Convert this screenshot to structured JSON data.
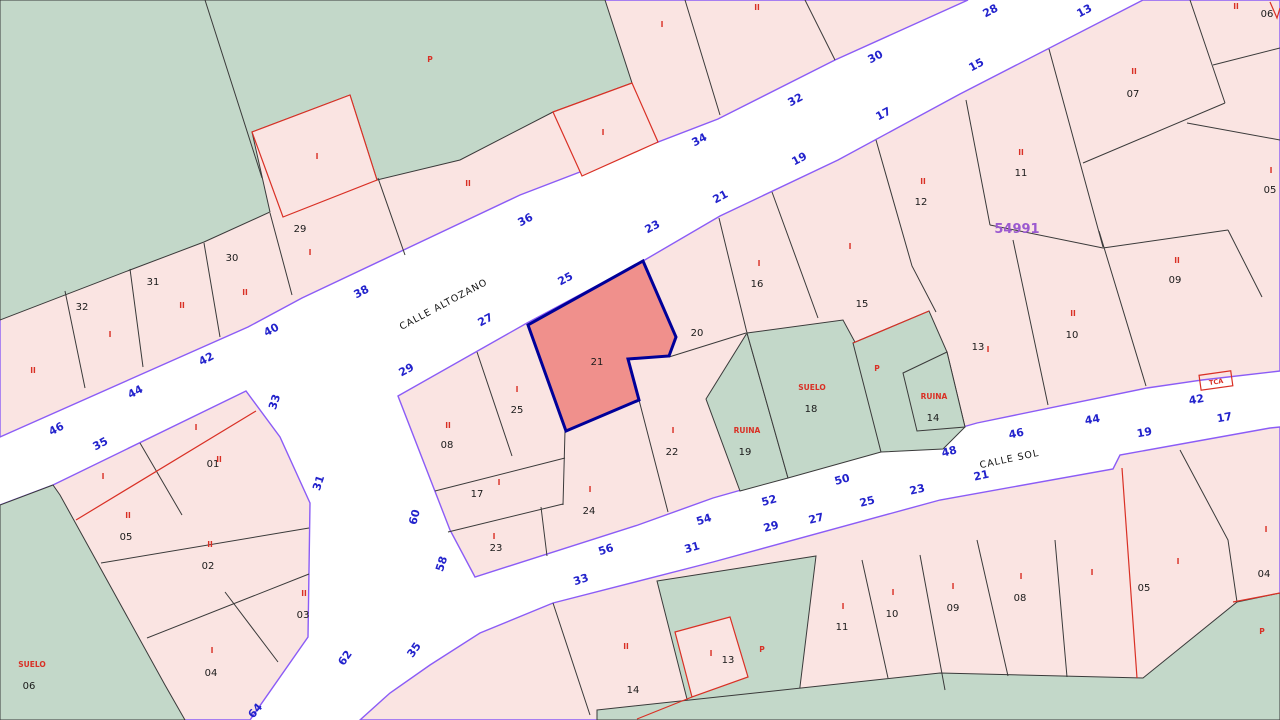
{
  "map_type": "cadastral-parcel-map",
  "block_number": {
    "t": "54991"
  },
  "tca": {
    "text": "TCA"
  },
  "highlighted_parcel": {
    "label": "21",
    "fill": "#f0908c",
    "stroke": "#000099"
  },
  "colors": {
    "street_white": "#ffffff",
    "parcel_pink": "#fae4e2",
    "green_area": "#c3d8c9",
    "block_outline_purple": "#8b5cf6",
    "parcel_line_black": "#3a3a3a",
    "annotation_red": "#d93025",
    "house_number_blue": "#2222cc",
    "block_number_purple": "#9b59d0"
  },
  "streets": [
    {
      "t": "CALLE ALTOZANO",
      "x": 445,
      "y": 307,
      "r": -28
    },
    {
      "t": "CALLE SOL",
      "x": 1010,
      "y": 462,
      "r": -12
    }
  ],
  "house_numbers": [
    {
      "t": "46",
      "x": 58,
      "y": 432,
      "r": -28
    },
    {
      "t": "44",
      "x": 137,
      "y": 395,
      "r": -28
    },
    {
      "t": "42",
      "x": 208,
      "y": 362,
      "r": -28
    },
    {
      "t": "40",
      "x": 273,
      "y": 333,
      "r": -28
    },
    {
      "t": "38",
      "x": 363,
      "y": 295,
      "r": -28
    },
    {
      "t": "36",
      "x": 527,
      "y": 223,
      "r": -28
    },
    {
      "t": "34",
      "x": 701,
      "y": 143,
      "r": -28
    },
    {
      "t": "32",
      "x": 797,
      "y": 103,
      "r": -28
    },
    {
      "t": "30",
      "x": 877,
      "y": 60,
      "r": -28
    },
    {
      "t": "28",
      "x": 992,
      "y": 14,
      "r": -28
    },
    {
      "t": "35",
      "x": 102,
      "y": 447,
      "r": -28
    },
    {
      "t": "29",
      "x": 408,
      "y": 373,
      "r": -28
    },
    {
      "t": "27",
      "x": 487,
      "y": 323,
      "r": -28
    },
    {
      "t": "25",
      "x": 567,
      "y": 282,
      "r": -28
    },
    {
      "t": "23",
      "x": 654,
      "y": 230,
      "r": -28
    },
    {
      "t": "21",
      "x": 722,
      "y": 200,
      "r": -28
    },
    {
      "t": "19",
      "x": 801,
      "y": 162,
      "r": -28
    },
    {
      "t": "17",
      "x": 885,
      "y": 117,
      "r": -28
    },
    {
      "t": "15",
      "x": 978,
      "y": 68,
      "r": -28
    },
    {
      "t": "13",
      "x": 1086,
      "y": 14,
      "r": -28
    },
    {
      "t": "33",
      "x": 278,
      "y": 403,
      "r": -72
    },
    {
      "t": "31",
      "x": 322,
      "y": 484,
      "r": -72
    },
    {
      "t": "60",
      "x": 418,
      "y": 518,
      "r": -75
    },
    {
      "t": "58",
      "x": 445,
      "y": 565,
      "r": -72
    },
    {
      "t": "62",
      "x": 348,
      "y": 660,
      "r": -55
    },
    {
      "t": "64",
      "x": 258,
      "y": 713,
      "r": -50
    },
    {
      "t": "35",
      "x": 417,
      "y": 652,
      "r": -55
    },
    {
      "t": "56",
      "x": 607,
      "y": 553,
      "r": -18
    },
    {
      "t": "54",
      "x": 705,
      "y": 523,
      "r": -18
    },
    {
      "t": "52",
      "x": 770,
      "y": 504,
      "r": -15
    },
    {
      "t": "50",
      "x": 843,
      "y": 483,
      "r": -15
    },
    {
      "t": "48",
      "x": 950,
      "y": 455,
      "r": -14
    },
    {
      "t": "46",
      "x": 1017,
      "y": 437,
      "r": -12
    },
    {
      "t": "44",
      "x": 1093,
      "y": 423,
      "r": -10
    },
    {
      "t": "42",
      "x": 1197,
      "y": 403,
      "r": -10
    },
    {
      "t": "33",
      "x": 582,
      "y": 583,
      "r": -18
    },
    {
      "t": "31",
      "x": 693,
      "y": 551,
      "r": -16
    },
    {
      "t": "29",
      "x": 772,
      "y": 530,
      "r": -15
    },
    {
      "t": "27",
      "x": 817,
      "y": 522,
      "r": -14
    },
    {
      "t": "25",
      "x": 868,
      "y": 505,
      "r": -14
    },
    {
      "t": "23",
      "x": 918,
      "y": 493,
      "r": -13
    },
    {
      "t": "21",
      "x": 982,
      "y": 479,
      "r": -12
    },
    {
      "t": "19",
      "x": 1145,
      "y": 436,
      "r": -10
    },
    {
      "t": "17",
      "x": 1225,
      "y": 421,
      "r": -10
    }
  ],
  "parcel_numbers": [
    {
      "t": "32",
      "x": 82,
      "y": 310
    },
    {
      "t": "31",
      "x": 153,
      "y": 285
    },
    {
      "t": "30",
      "x": 232,
      "y": 261
    },
    {
      "t": "29",
      "x": 300,
      "y": 232
    },
    {
      "t": "01",
      "x": 213,
      "y": 467
    },
    {
      "t": "05",
      "x": 126,
      "y": 540
    },
    {
      "t": "02",
      "x": 208,
      "y": 569
    },
    {
      "t": "03",
      "x": 303,
      "y": 618
    },
    {
      "t": "04",
      "x": 211,
      "y": 676
    },
    {
      "t": "06",
      "x": 29,
      "y": 689
    },
    {
      "t": "08",
      "x": 447,
      "y": 448
    },
    {
      "t": "25",
      "x": 517,
      "y": 413
    },
    {
      "t": "17",
      "x": 477,
      "y": 497
    },
    {
      "t": "23",
      "x": 496,
      "y": 551
    },
    {
      "t": "24",
      "x": 589,
      "y": 514
    },
    {
      "t": "21",
      "x": 597,
      "y": 365
    },
    {
      "t": "22",
      "x": 672,
      "y": 455
    },
    {
      "t": "20",
      "x": 697,
      "y": 336
    },
    {
      "t": "16",
      "x": 757,
      "y": 287
    },
    {
      "t": "15",
      "x": 862,
      "y": 307
    },
    {
      "t": "12",
      "x": 921,
      "y": 205
    },
    {
      "t": "11",
      "x": 1021,
      "y": 176
    },
    {
      "t": "07",
      "x": 1133,
      "y": 97
    },
    {
      "t": "06",
      "x": 1267,
      "y": 17
    },
    {
      "t": "05",
      "x": 1270,
      "y": 193
    },
    {
      "t": "13",
      "x": 978,
      "y": 350
    },
    {
      "t": "09",
      "x": 1175,
      "y": 283
    },
    {
      "t": "10",
      "x": 1072,
      "y": 338
    },
    {
      "t": "18",
      "x": 811,
      "y": 412
    },
    {
      "t": "19",
      "x": 745,
      "y": 455
    },
    {
      "t": "14",
      "x": 933,
      "y": 421
    },
    {
      "t": "14",
      "x": 633,
      "y": 693
    },
    {
      "t": "13",
      "x": 728,
      "y": 663
    },
    {
      "t": "11",
      "x": 842,
      "y": 630
    },
    {
      "t": "10",
      "x": 892,
      "y": 617
    },
    {
      "t": "09",
      "x": 953,
      "y": 611
    },
    {
      "t": "08",
      "x": 1020,
      "y": 601
    },
    {
      "t": "05",
      "x": 1144,
      "y": 591
    },
    {
      "t": "04",
      "x": 1264,
      "y": 577
    }
  ],
  "red_marks": [
    {
      "t": "I",
      "x": 317,
      "y": 159
    },
    {
      "t": "I",
      "x": 603,
      "y": 135
    },
    {
      "t": "II",
      "x": 468,
      "y": 186
    },
    {
      "t": "P",
      "x": 430,
      "y": 62
    },
    {
      "t": "I",
      "x": 662,
      "y": 27
    },
    {
      "t": "II",
      "x": 757,
      "y": 10
    },
    {
      "t": "I",
      "x": 110,
      "y": 337
    },
    {
      "t": "II",
      "x": 182,
      "y": 308
    },
    {
      "t": "II",
      "x": 33,
      "y": 373
    },
    {
      "t": "II",
      "x": 245,
      "y": 295
    },
    {
      "t": "I",
      "x": 310,
      "y": 255
    },
    {
      "t": "I",
      "x": 196,
      "y": 430
    },
    {
      "t": "II",
      "x": 219,
      "y": 462
    },
    {
      "t": "I",
      "x": 103,
      "y": 479
    },
    {
      "t": "II",
      "x": 128,
      "y": 518
    },
    {
      "t": "II",
      "x": 210,
      "y": 547
    },
    {
      "t": "II",
      "x": 304,
      "y": 596
    },
    {
      "t": "I",
      "x": 212,
      "y": 653
    },
    {
      "t": "SUELO",
      "x": 32,
      "y": 667
    },
    {
      "t": "II",
      "x": 448,
      "y": 428
    },
    {
      "t": "I",
      "x": 517,
      "y": 392
    },
    {
      "t": "I",
      "x": 499,
      "y": 485
    },
    {
      "t": "I",
      "x": 494,
      "y": 539
    },
    {
      "t": "I",
      "x": 590,
      "y": 492
    },
    {
      "t": "I",
      "x": 673,
      "y": 433
    },
    {
      "t": "I",
      "x": 759,
      "y": 266
    },
    {
      "t": "I",
      "x": 850,
      "y": 249
    },
    {
      "t": "II",
      "x": 923,
      "y": 184
    },
    {
      "t": "II",
      "x": 1021,
      "y": 155
    },
    {
      "t": "II",
      "x": 1134,
      "y": 74
    },
    {
      "t": "II",
      "x": 1236,
      "y": 9
    },
    {
      "t": "I",
      "x": 1271,
      "y": 173
    },
    {
      "t": "I",
      "x": 988,
      "y": 352
    },
    {
      "t": "II",
      "x": 1177,
      "y": 263
    },
    {
      "t": "II",
      "x": 1073,
      "y": 316
    },
    {
      "t": "SUELO",
      "x": 812,
      "y": 390
    },
    {
      "t": "RUINA",
      "x": 747,
      "y": 433
    },
    {
      "t": "RUINA",
      "x": 934,
      "y": 399
    },
    {
      "t": "P",
      "x": 877,
      "y": 371
    },
    {
      "t": "II",
      "x": 626,
      "y": 649
    },
    {
      "t": "I",
      "x": 711,
      "y": 656
    },
    {
      "t": "P",
      "x": 762,
      "y": 652
    },
    {
      "t": "I",
      "x": 843,
      "y": 609
    },
    {
      "t": "I",
      "x": 893,
      "y": 595
    },
    {
      "t": "I",
      "x": 953,
      "y": 589
    },
    {
      "t": "I",
      "x": 1021,
      "y": 579
    },
    {
      "t": "I",
      "x": 1092,
      "y": 575
    },
    {
      "t": "I",
      "x": 1178,
      "y": 564
    },
    {
      "t": "I",
      "x": 1266,
      "y": 532
    },
    {
      "t": "P",
      "x": 1262,
      "y": 634
    }
  ]
}
